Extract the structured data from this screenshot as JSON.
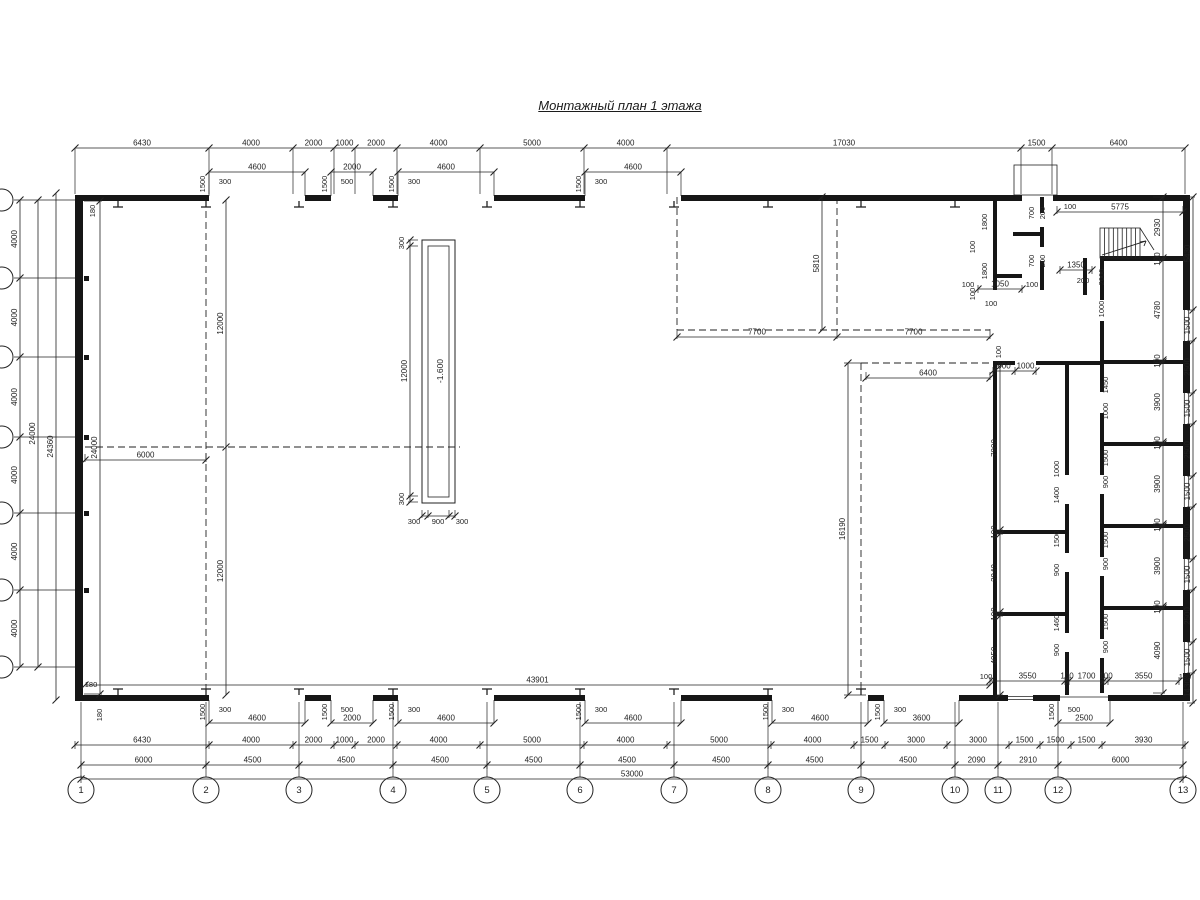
{
  "title": "Монтажный план 1 этажа",
  "pit": {
    "outer": [
      422,
      240,
      33,
      263
    ],
    "inner": [
      428,
      246,
      21,
      251
    ],
    "label": "-1.600",
    "label_xy": [
      440,
      371
    ]
  },
  "axes_bottom": [
    {
      "n": "1",
      "x": 81
    },
    {
      "n": "2",
      "x": 206
    },
    {
      "n": "3",
      "x": 299
    },
    {
      "n": "4",
      "x": 393
    },
    {
      "n": "5",
      "x": 487
    },
    {
      "n": "6",
      "x": 580
    },
    {
      "n": "7",
      "x": 674
    },
    {
      "n": "8",
      "x": 768
    },
    {
      "n": "9",
      "x": 861
    },
    {
      "n": "10",
      "x": 955
    },
    {
      "n": "11",
      "x": 998
    },
    {
      "n": "12",
      "x": 1058
    },
    {
      "n": "13",
      "x": 1183
    }
  ],
  "axes_bottom_cy": 790,
  "left_axis_ys": [
    200,
    278,
    357,
    437,
    513,
    590,
    667
  ],
  "hdims": [
    {
      "y": 148,
      "t": [
        75,
        209,
        293,
        334,
        355,
        397,
        480,
        584,
        667,
        1021,
        1052,
        1185
      ],
      "l": [
        "6430",
        "4000",
        "2000",
        "1000",
        "2000",
        "4000",
        "5000",
        "4000",
        "17030",
        "1500",
        "6400"
      ],
      "e": [
        0,
        46
      ]
    },
    {
      "y": 745,
      "t": [
        75,
        209,
        293,
        334,
        355,
        397,
        480,
        584,
        667,
        771,
        854,
        885,
        947,
        1009,
        1040,
        1071,
        1102,
        1185
      ],
      "l": [
        "6430",
        "4000",
        "2000",
        "1000",
        "2000",
        "4000",
        "5000",
        "4000",
        "5000",
        "4000",
        "1500",
        "3000",
        "3000",
        "1500",
        "1500",
        "1500",
        "3930"
      ],
      "e": [
        -4,
        4
      ]
    },
    {
      "y": 765,
      "t": [
        81,
        206,
        299,
        393,
        487,
        580,
        674,
        768,
        861,
        955,
        998,
        1058,
        1183
      ],
      "l": [
        "6000",
        "4500",
        "4500",
        "4500",
        "4500",
        "4500",
        "4500",
        "4500",
        "4500",
        "2090",
        "2910",
        "6000"
      ],
      "e": [
        -4,
        4
      ]
    },
    {
      "y": 779,
      "t": [
        81,
        1183
      ],
      "l": [
        "53000"
      ],
      "e": [
        -4,
        4
      ]
    },
    {
      "y": 685,
      "t": [
        85,
        990
      ],
      "l": [
        "43901"
      ]
    },
    {
      "y": 337,
      "t": [
        677,
        837,
        990
      ],
      "l": [
        "7700",
        "7700"
      ],
      "e": [
        -8,
        2
      ]
    },
    {
      "y": 378,
      "t": [
        866,
        990
      ],
      "l": [
        "6400"
      ],
      "e": [
        -6,
        2
      ]
    },
    {
      "y": 460,
      "t": [
        85,
        206
      ],
      "l": [
        "6000"
      ],
      "e": [
        -6,
        2
      ]
    },
    {
      "y": 212,
      "t": [
        1057,
        1183
      ],
      "l": [
        "5775"
      ],
      "e": [
        -6,
        2
      ]
    },
    {
      "y": 289,
      "t": [
        978,
        1022
      ],
      "l": [
        "1050"
      ],
      "e": [
        -4,
        4
      ]
    },
    {
      "y": 270,
      "t": [
        1060,
        1092
      ],
      "l": [
        "1350"
      ],
      "e": [
        -4,
        4
      ]
    },
    {
      "y": 681,
      "t": [
        990,
        1065,
        1069,
        1104,
        1108,
        1179
      ],
      "l": [
        "3550",
        "100",
        "1700",
        "100",
        "3550"
      ],
      "e": [
        -4,
        4
      ]
    },
    {
      "y": 371,
      "t": [
        993,
        1015,
        1036
      ],
      "l": [
        "900",
        "1000"
      ],
      "e": [
        -4,
        4
      ]
    },
    {
      "y": 516,
      "t": [
        422,
        428,
        449,
        455
      ],
      "l": [
        "",
        "",
        ""
      ],
      "e": [
        -6,
        2
      ]
    }
  ],
  "vdims": [
    {
      "x": 20,
      "t": [
        200,
        278,
        357,
        437,
        513,
        590,
        667
      ],
      "l": [
        "4000",
        "4000",
        "4000",
        "4000",
        "4000",
        "4000"
      ]
    },
    {
      "x": 38,
      "t": [
        200,
        667
      ],
      "l": [
        "24000"
      ]
    },
    {
      "x": 56,
      "t": [
        193,
        700
      ],
      "l": [
        "24360"
      ]
    },
    {
      "x": 100,
      "t": [
        201,
        694
      ],
      "l": [
        "24000"
      ],
      "e": [
        -16,
        2
      ]
    },
    {
      "x": 226,
      "t": [
        200,
        447,
        695
      ],
      "l": [
        "12000",
        "12000"
      ]
    },
    {
      "x": 822,
      "t": [
        197,
        330
      ],
      "l": [
        "5810"
      ]
    },
    {
      "x": 848,
      "t": [
        363,
        695
      ],
      "l": [
        "16190"
      ],
      "e": [
        -4,
        18
      ]
    },
    {
      "x": 1163,
      "t": [
        197,
        258,
        260,
        360,
        362,
        442,
        444,
        524,
        526,
        606,
        608,
        693
      ],
      "l": [
        "2930",
        "100",
        "4780",
        "100",
        "3900",
        "100",
        "3900",
        "100",
        "3900",
        "100",
        "4090"
      ],
      "e": [
        -10,
        2
      ]
    },
    {
      "x": 1193,
      "t": [
        197,
        310,
        341,
        393,
        424,
        476,
        507,
        559,
        590,
        642,
        673,
        703
      ],
      "l": [
        "5430",
        "1500",
        "2500",
        "1500",
        "2500",
        "1500",
        "2500",
        "1500",
        "2500",
        "1500",
        "1430"
      ],
      "e": [
        -6,
        2
      ]
    },
    {
      "x": 1000,
      "t": [
        366,
        530,
        534,
        612,
        616,
        695
      ],
      "l": [
        "7900",
        "100",
        "3940",
        "100",
        "4050"
      ],
      "e": [
        -5,
        3
      ]
    },
    {
      "x": 410,
      "t": [
        240,
        246,
        496,
        502
      ],
      "l": [
        "",
        "12000",
        ""
      ],
      "e": [
        -2,
        8
      ]
    }
  ],
  "boxes_top": [
    {
      "x1": 209,
      "x2": 305,
      "big": "4600",
      "small": "300",
      "side_label": "1500"
    },
    {
      "x1": 331,
      "x2": 373,
      "big": "2000",
      "small": "500",
      "side_label": "1500"
    },
    {
      "x1": 398,
      "x2": 494,
      "big": "4600",
      "small": "300",
      "side_label": "1500"
    },
    {
      "x1": 585,
      "x2": 681,
      "big": "4600",
      "small": "300",
      "side_label": "1500"
    }
  ],
  "boxes_bottom": [
    {
      "x1": 209,
      "x2": 305,
      "big": "4600",
      "small": "300",
      "side_label": "1500"
    },
    {
      "x1": 331,
      "x2": 373,
      "big": "2000",
      "small": "500",
      "side_label": "1500"
    },
    {
      "x1": 398,
      "x2": 494,
      "big": "4600",
      "small": "300",
      "side_label": "1500"
    },
    {
      "x1": 585,
      "x2": 681,
      "big": "4600",
      "small": "300",
      "side_label": "1500"
    },
    {
      "x1": 772,
      "x2": 868,
      "big": "4600",
      "small": "300",
      "side_label": "1500"
    },
    {
      "x1": 884,
      "x2": 959,
      "big": "3600",
      "small": "300",
      "side_label": "1500"
    },
    {
      "x1": 1058,
      "x2": 1110,
      "big": "2500",
      "small": "500",
      "side_label": "1500"
    }
  ],
  "texts": [
    {
      "x": 95,
      "y": 211,
      "t": "180",
      "r": 1
    },
    {
      "x": 91,
      "y": 687,
      "t": "180"
    },
    {
      "x": 102,
      "y": 715,
      "t": "180",
      "r": 1
    },
    {
      "x": 987,
      "y": 222,
      "t": "1800",
      "r": 1
    },
    {
      "x": 975,
      "y": 247,
      "t": "100",
      "r": 1
    },
    {
      "x": 987,
      "y": 271,
      "t": "1800",
      "r": 1
    },
    {
      "x": 975,
      "y": 294,
      "t": "100",
      "r": 1
    },
    {
      "x": 991,
      "y": 306,
      "t": "100"
    },
    {
      "x": 1034,
      "y": 213,
      "t": "700",
      "r": 1
    },
    {
      "x": 1045,
      "y": 213,
      "t": "200",
      "r": 1
    },
    {
      "x": 1034,
      "y": 261,
      "t": "700",
      "r": 1
    },
    {
      "x": 1045,
      "y": 261,
      "t": "200",
      "r": 1
    },
    {
      "x": 968,
      "y": 287,
      "t": "100"
    },
    {
      "x": 1032,
      "y": 287,
      "t": "100"
    },
    {
      "x": 1070,
      "y": 209,
      "t": "100"
    },
    {
      "x": 1083,
      "y": 283,
      "t": "200"
    },
    {
      "x": 1104,
      "y": 277,
      "t": "2000",
      "r": 1
    },
    {
      "x": 1104,
      "y": 309,
      "t": "1000",
      "r": 1
    },
    {
      "x": 1001,
      "y": 352,
      "t": "100",
      "r": 1
    },
    {
      "x": 1059,
      "y": 469,
      "t": "1000",
      "r": 1
    },
    {
      "x": 1059,
      "y": 495,
      "t": "1400",
      "r": 1
    },
    {
      "x": 1059,
      "y": 539,
      "t": "1500",
      "r": 1
    },
    {
      "x": 1059,
      "y": 570,
      "t": "900",
      "r": 1
    },
    {
      "x": 1059,
      "y": 623,
      "t": "1460",
      "r": 1
    },
    {
      "x": 1059,
      "y": 650,
      "t": "900",
      "r": 1
    },
    {
      "x": 1108,
      "y": 385,
      "t": "1450",
      "r": 1
    },
    {
      "x": 1108,
      "y": 411,
      "t": "1000",
      "r": 1
    },
    {
      "x": 1108,
      "y": 458,
      "t": "1500",
      "r": 1
    },
    {
      "x": 1108,
      "y": 482,
      "t": "900",
      "r": 1
    },
    {
      "x": 1108,
      "y": 540,
      "t": "1500",
      "r": 1
    },
    {
      "x": 1108,
      "y": 564,
      "t": "900",
      "r": 1
    },
    {
      "x": 1108,
      "y": 622,
      "t": "1500",
      "r": 1
    },
    {
      "x": 1108,
      "y": 647,
      "t": "900",
      "r": 1
    },
    {
      "x": 404,
      "y": 243,
      "t": "300",
      "r": 1
    },
    {
      "x": 404,
      "y": 499,
      "t": "300",
      "r": 1
    },
    {
      "x": 414,
      "y": 524,
      "t": "300"
    },
    {
      "x": 438,
      "y": 524,
      "t": "900"
    },
    {
      "x": 462,
      "y": 524,
      "t": "300"
    },
    {
      "x": 986,
      "y": 679,
      "t": "100"
    },
    {
      "x": 1185,
      "y": 679,
      "t": "180"
    }
  ],
  "walls": [
    [
      75,
      195,
      134,
      6
    ],
    [
      305,
      195,
      26,
      6
    ],
    [
      373,
      195,
      25,
      6
    ],
    [
      494,
      195,
      91,
      6
    ],
    [
      681,
      195,
      341,
      6
    ],
    [
      1053,
      195,
      137,
      6
    ],
    [
      75,
      695,
      134,
      6
    ],
    [
      305,
      695,
      26,
      6
    ],
    [
      373,
      695,
      25,
      6
    ],
    [
      494,
      695,
      91,
      6
    ],
    [
      681,
      695,
      91,
      6
    ],
    [
      868,
      695,
      16,
      6
    ],
    [
      959,
      695,
      49,
      6
    ],
    [
      1033,
      695,
      27,
      6
    ],
    [
      1108,
      695,
      82,
      6
    ],
    [
      75,
      195,
      8,
      506
    ],
    [
      1183,
      195,
      7,
      115
    ],
    [
      1183,
      341,
      7,
      52
    ],
    [
      1183,
      424,
      7,
      52
    ],
    [
      1183,
      507,
      7,
      52
    ],
    [
      1183,
      590,
      7,
      52
    ],
    [
      1183,
      673,
      7,
      28
    ],
    [
      993,
      197,
      4,
      93
    ],
    [
      993,
      363,
      4,
      332
    ],
    [
      1040,
      197,
      4,
      16
    ],
    [
      1040,
      227,
      4,
      20
    ],
    [
      1040,
      261,
      4,
      29
    ],
    [
      993,
      274,
      29,
      4
    ],
    [
      1013,
      232,
      27,
      4
    ],
    [
      1065,
      363,
      4,
      112
    ],
    [
      1065,
      504,
      4,
      49
    ],
    [
      1065,
      572,
      4,
      61
    ],
    [
      1065,
      652,
      4,
      43
    ],
    [
      1100,
      258,
      4,
      42
    ],
    [
      1100,
      321,
      4,
      71
    ],
    [
      1100,
      413,
      4,
      62
    ],
    [
      1100,
      494,
      4,
      63
    ],
    [
      1100,
      576,
      4,
      63
    ],
    [
      1100,
      658,
      4,
      35
    ],
    [
      1083,
      258,
      4,
      37
    ],
    [
      1100,
      256,
      83,
      5
    ],
    [
      1100,
      360,
      83,
      4
    ],
    [
      1100,
      442,
      83,
      4
    ],
    [
      1100,
      524,
      83,
      4
    ],
    [
      1100,
      606,
      83,
      4
    ],
    [
      993,
      361,
      22,
      4
    ],
    [
      1036,
      361,
      64,
      4
    ],
    [
      993,
      530,
      76,
      4
    ],
    [
      993,
      612,
      76,
      4
    ]
  ],
  "squares": [
    [
      84,
      276
    ],
    [
      84,
      355
    ],
    [
      84,
      435
    ],
    [
      84,
      511
    ],
    [
      84,
      588
    ]
  ],
  "columns_top": [
    118,
    206,
    299,
    393,
    487,
    580,
    674,
    768,
    861,
    955
  ],
  "columns_bottom": [
    118,
    206,
    299,
    393,
    487,
    580,
    674,
    768,
    861
  ],
  "dashed": [
    [
      206,
      200,
      206,
      695
    ],
    [
      85,
      447,
      460,
      447
    ],
    [
      677,
      197,
      677,
      330
    ],
    [
      677,
      330,
      990,
      330
    ],
    [
      837,
      197,
      837,
      330
    ],
    [
      861,
      363,
      861,
      695
    ],
    [
      861,
      363,
      990,
      363
    ]
  ],
  "thin": [
    [
      1060,
      697,
      1108,
      697
    ]
  ],
  "vestibule_rect": [
    1014,
    165,
    43,
    30
  ],
  "windows_right": [
    [
      310,
      341
    ],
    [
      393,
      424
    ],
    [
      476,
      507
    ],
    [
      559,
      590
    ],
    [
      642,
      673
    ]
  ],
  "window_bottom": [
    1008,
    1033
  ],
  "stairs": {
    "x": 1100,
    "y": 228,
    "w": 40,
    "h": 30,
    "risers": 8
  }
}
